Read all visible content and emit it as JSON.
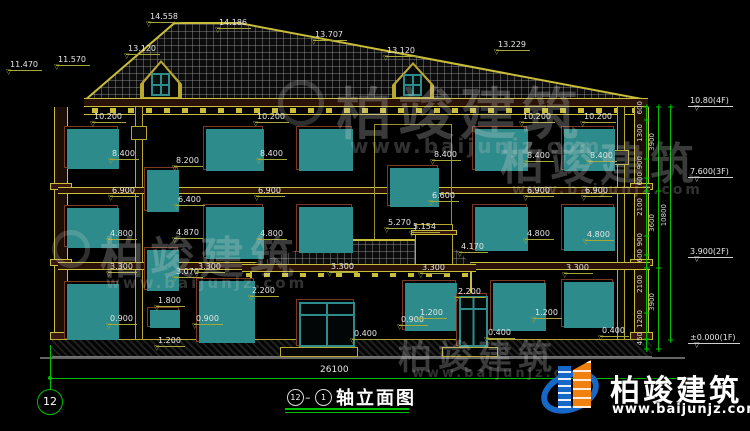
{
  "drawing": {
    "title_axis_start": "12",
    "title_axis_end": "1",
    "title_text": "轴立面图",
    "axis_bubble_left": "12",
    "overall_width": "26100"
  },
  "watermark": {
    "brand": "柏竣建筑",
    "url": "www.baijunjz.com"
  },
  "elevation_marks": [
    {
      "text": "10.80(4F)",
      "y": 96
    },
    {
      "text": "7.600(3F)",
      "y": 167
    },
    {
      "text": "3.900(2F)",
      "y": 247
    },
    {
      "text": "±0.000(1F)",
      "y": 333
    }
  ],
  "dimensions": [
    {
      "t": "14.558",
      "x": 148,
      "y": 12
    },
    {
      "t": "14.186",
      "x": 217,
      "y": 18
    },
    {
      "t": "13.707",
      "x": 313,
      "y": 30
    },
    {
      "t": "13.229",
      "x": 496,
      "y": 40
    },
    {
      "t": "13.120",
      "x": 126,
      "y": 44
    },
    {
      "t": "13.120",
      "x": 385,
      "y": 46
    },
    {
      "t": "11.470",
      "x": 8,
      "y": 60
    },
    {
      "t": "11.570",
      "x": 56,
      "y": 55
    },
    {
      "t": "10.200",
      "x": 92,
      "y": 112
    },
    {
      "t": "10.200",
      "x": 255,
      "y": 112
    },
    {
      "t": "10.200",
      "x": 521,
      "y": 112
    },
    {
      "t": "10.200",
      "x": 582,
      "y": 112
    },
    {
      "t": "8.400",
      "x": 110,
      "y": 149
    },
    {
      "t": "8.200",
      "x": 174,
      "y": 156
    },
    {
      "t": "8.400",
      "x": 258,
      "y": 149
    },
    {
      "t": "8.400",
      "x": 432,
      "y": 150
    },
    {
      "t": "8.400",
      "x": 525,
      "y": 151
    },
    {
      "t": "8.400",
      "x": 588,
      "y": 151
    },
    {
      "t": "6.900",
      "x": 110,
      "y": 186
    },
    {
      "t": "6.400",
      "x": 176,
      "y": 195
    },
    {
      "t": "6.900",
      "x": 256,
      "y": 186
    },
    {
      "t": "6.600",
      "x": 430,
      "y": 191
    },
    {
      "t": "6.900",
      "x": 525,
      "y": 186
    },
    {
      "t": "6.900",
      "x": 583,
      "y": 186
    },
    {
      "t": "4.800",
      "x": 108,
      "y": 229
    },
    {
      "t": "4.870",
      "x": 174,
      "y": 228
    },
    {
      "t": "4.800",
      "x": 258,
      "y": 229
    },
    {
      "t": "4.800",
      "x": 525,
      "y": 229
    },
    {
      "t": "4.800",
      "x": 585,
      "y": 230
    },
    {
      "t": "5.270",
      "x": 386,
      "y": 218
    },
    {
      "t": "5.154",
      "x": 411,
      "y": 222
    },
    {
      "t": "4.170",
      "x": 459,
      "y": 242
    },
    {
      "t": "3.300",
      "x": 108,
      "y": 262
    },
    {
      "t": "3.070",
      "x": 174,
      "y": 267
    },
    {
      "t": "3.300",
      "x": 196,
      "y": 262
    },
    {
      "t": "3.300",
      "x": 329,
      "y": 262
    },
    {
      "t": "3.300",
      "x": 420,
      "y": 263
    },
    {
      "t": "3.300",
      "x": 564,
      "y": 263
    },
    {
      "t": "2.200",
      "x": 250,
      "y": 286
    },
    {
      "t": "2.200",
      "x": 456,
      "y": 287
    },
    {
      "t": "1.800",
      "x": 156,
      "y": 296
    },
    {
      "t": "0.900",
      "x": 108,
      "y": 314
    },
    {
      "t": "0.900",
      "x": 194,
      "y": 314
    },
    {
      "t": "0.900",
      "x": 399,
      "y": 315
    },
    {
      "t": "1.200",
      "x": 418,
      "y": 308
    },
    {
      "t": "1.200",
      "x": 533,
      "y": 308
    },
    {
      "t": "1.200",
      "x": 156,
      "y": 336
    },
    {
      "t": "0.400",
      "x": 352,
      "y": 329
    },
    {
      "t": "0.400",
      "x": 486,
      "y": 328
    },
    {
      "t": "0.400",
      "x": 600,
      "y": 326
    }
  ],
  "chain": {
    "col1": {
      "x": 646,
      "boundaries": [
        108,
        121,
        160,
        179,
        192,
        237,
        256,
        269,
        314,
        340,
        350
      ],
      "values": [
        "600",
        "1300",
        "900",
        "600",
        "2100",
        "900",
        "600",
        "2100",
        "1200",
        "450"
      ]
    },
    "col2": {
      "x": 658,
      "boundaries": [
        108,
        192,
        269,
        350
      ],
      "values": [
        "3900",
        "3600",
        "3900"
      ]
    },
    "col3": {
      "x": 670,
      "boundaries": [
        108,
        341
      ],
      "values": [
        "10800"
      ]
    }
  },
  "colors": {
    "line_green": "#00c000",
    "line_yellow": "#b8a830",
    "dim_text": "#e6e6e6",
    "window_teal": "#2e8b8b",
    "trim_maroon": "#7a3a22",
    "logo_blue": "#1668c8",
    "logo_orange": "#f08010"
  }
}
